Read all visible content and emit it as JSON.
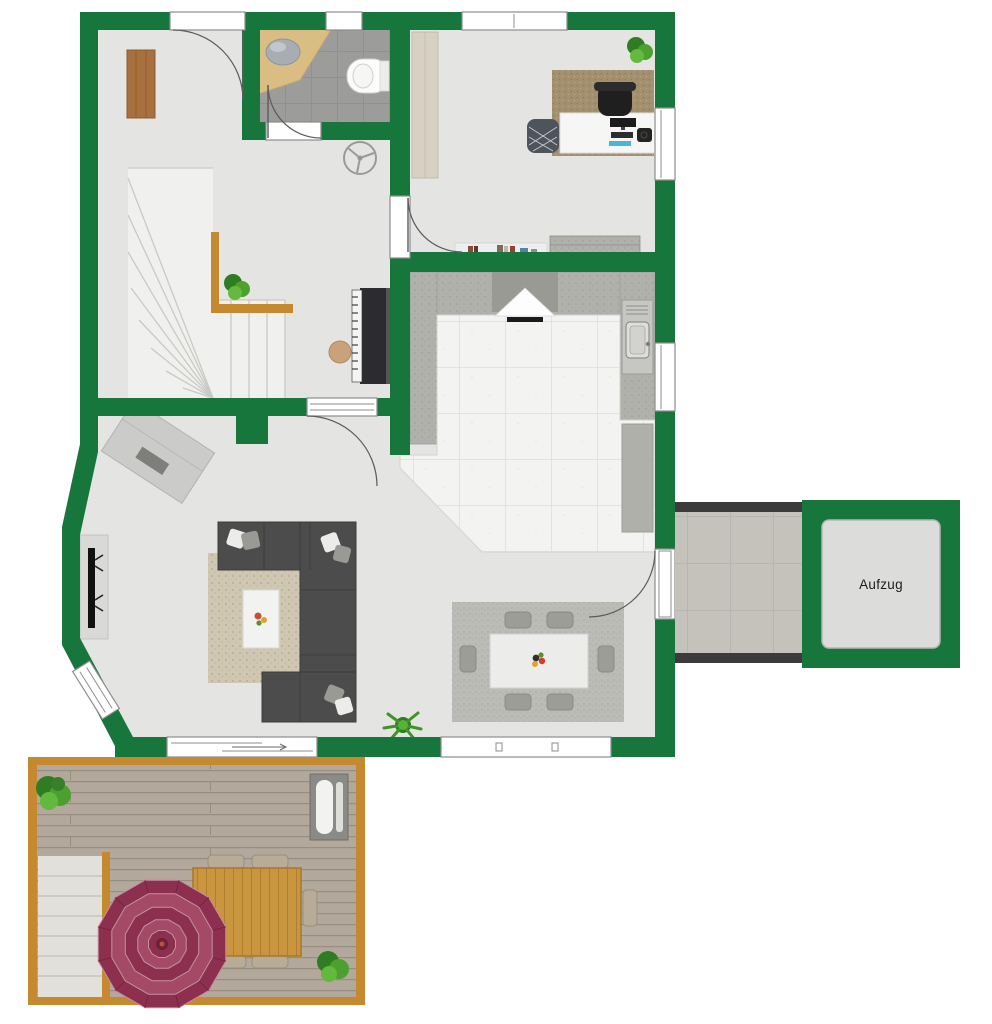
{
  "labels": {
    "elevator": "Aufzug"
  },
  "colors": {
    "wall": "#17763c",
    "floor": "#e4e4e2",
    "stair": "#f0f0ee",
    "deck": "#b2a89c",
    "wood_frame": "#c5892f",
    "sofa": "#4c4c4c",
    "parasol_dark": "#8d2f4e",
    "parasol_light": "#a54a66",
    "corridor_wall": "#3b3b3b",
    "elevator_cab": "#dcdcda",
    "plant_green": "#4ba02f",
    "bath_tile": "#9c9c9a",
    "kitchen_tile": "#f3f3f1",
    "sideboard_wood": "#a9703f"
  }
}
